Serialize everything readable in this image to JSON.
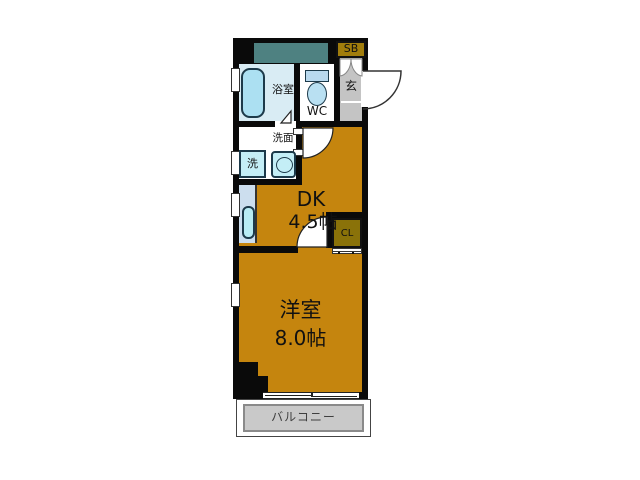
{
  "floor_plan": {
    "type": "apartment-floor-plan",
    "rooms": [
      {
        "id": "dk",
        "label": "DK",
        "size": "4.5帖"
      },
      {
        "id": "western_room",
        "label": "洋室",
        "size": "8.0帖"
      },
      {
        "id": "bathroom",
        "label": "浴室"
      },
      {
        "id": "toilet",
        "label": "WC"
      },
      {
        "id": "entrance",
        "label": "玄"
      },
      {
        "id": "washroom",
        "label": "洗面"
      },
      {
        "id": "washing_machine",
        "label": "洗"
      },
      {
        "id": "shoe_box",
        "label": "SB"
      },
      {
        "id": "closet",
        "label": "CL"
      },
      {
        "id": "balcony",
        "label": "バルコニー"
      }
    ],
    "colors": {
      "wall": "#0a0a0a",
      "room_orange": "#c5850e",
      "closet_olive": "#8a7209",
      "shoebox_gold": "#a17d0c",
      "pipe_space_teal": "#4e8181",
      "entrance_gray": "#c4c4c4",
      "balcony_gray": "#c9c9c9",
      "balcony_border_gray": "#8a8a8a",
      "bathroom_blue": "#d9ecf4",
      "bathtub_blue": "#ace0f2",
      "fixture_cyan": "#c4eef6",
      "counter_blue": "#ccdeee"
    }
  }
}
